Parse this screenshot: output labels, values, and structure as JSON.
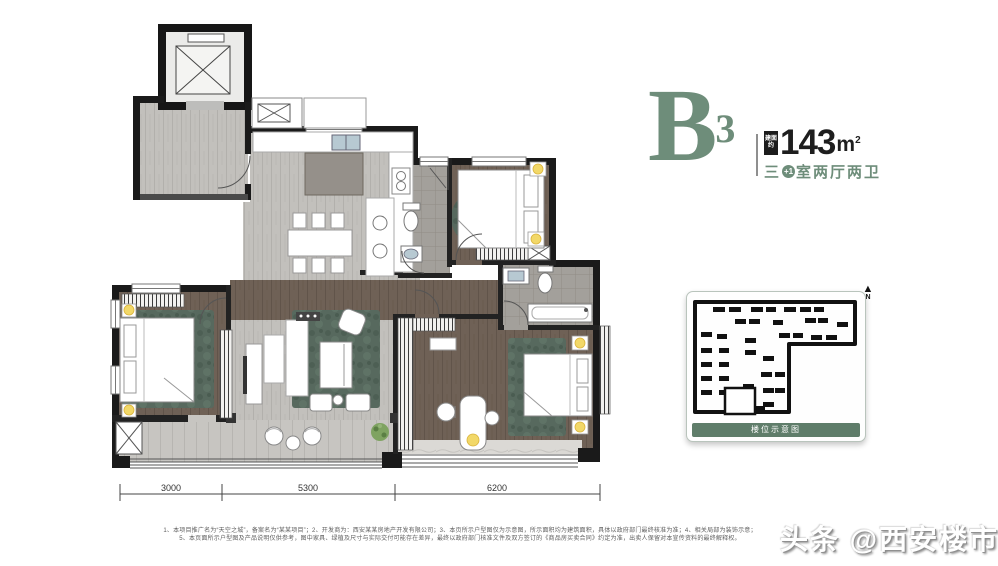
{
  "title_block": {
    "unit_letter": "B",
    "unit_sup": "3",
    "area_badge_line1": "建面",
    "area_badge_line2": "约",
    "area_value": "143",
    "area_unit": "m",
    "area_unit_sup": "2",
    "layout_prefix": "三",
    "layout_badge": "+1",
    "layout_suffix": "室两厅两卫",
    "accent_color": "#6e8d7a"
  },
  "floor_plan": {
    "dimensions": [
      "3000",
      "5300",
      "6200"
    ]
  },
  "site_plan": {
    "caption": "楼位示意图",
    "north_label": "N"
  },
  "disclaimer": {
    "line1": "1、本项目推广名为“天空之城”，备案名为“某某项目”；2、开发商为：西安某某房地产开发有限公司；3、本页所示户型图仅为示意图，所示面积均为建筑面积，具体以政府部门最终核准为准；4、相关局部为装饰示意；",
    "line2": "5、本页面所示户型图及产品说明仅供参考，图中家具、绿植及尺寸与实际交付可能存在差异，最终以政府部门核准文件及双方签订的《商品房买卖合同》约定为准，出卖人保留对本宣传资料的最终解释权。"
  },
  "watermark": "头条 @西安楼市1"
}
